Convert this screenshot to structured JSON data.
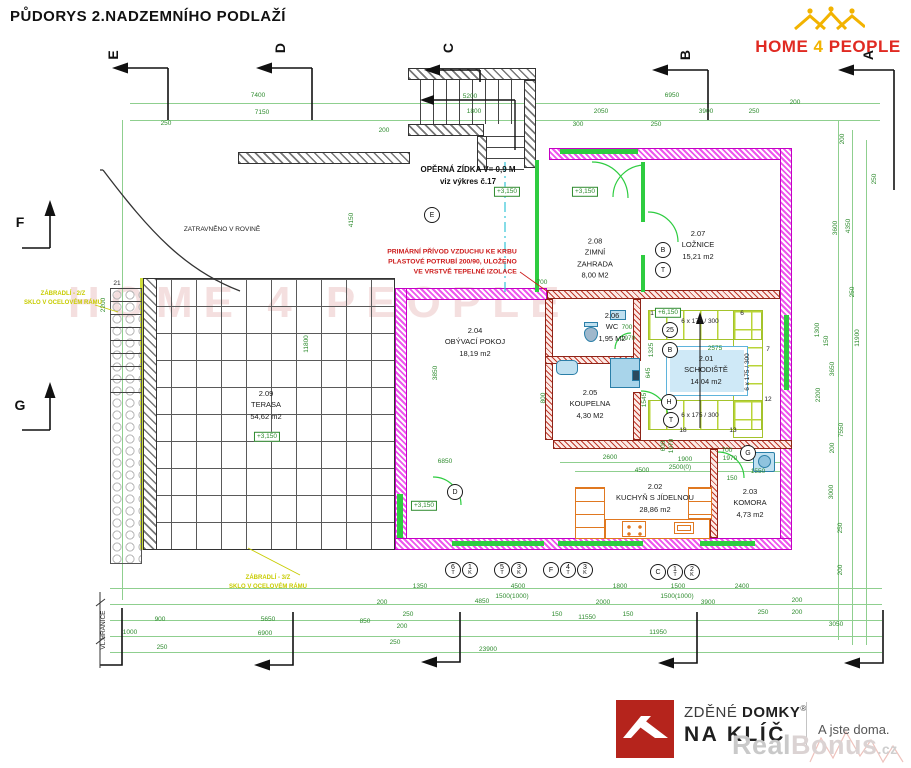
{
  "title": "PŮDORYS 2.NADZEMNÍHO PODLAŽÍ",
  "logo": {
    "word1": "HOME",
    "word2": "4",
    "word3": "PEOPLE"
  },
  "watermark_plan": "HOME 4 PEOPLE",
  "footer": {
    "brand1a": "ZDĚNÉ ",
    "brand1b": "DOMKY",
    "reg": "®",
    "brand2": "NA KLÍČ",
    "tagline": "A jste doma.",
    "wm1": "Real",
    "wm2": "Bonus",
    "wm3": ".cz"
  },
  "plan": {
    "rooms": [
      {
        "id": "2.01",
        "name": "SCHODIŠTĚ",
        "area": "14,04 m2",
        "x": 706,
        "y": 370
      },
      {
        "id": "2.02",
        "name": "KUCHYŇ S JÍDELNOU",
        "area": "28,86 m2",
        "x": 655,
        "y": 498
      },
      {
        "id": "2.03",
        "name": "KOMORA",
        "area": "4,73 m2",
        "x": 750,
        "y": 503
      },
      {
        "id": "2.04",
        "name": "OBÝVACÍ POKOJ",
        "area": "18,19 m2",
        "x": 475,
        "y": 342
      },
      {
        "id": "2.05",
        "name": "KOUPELNA",
        "area": "4,30 M2",
        "x": 590,
        "y": 404
      },
      {
        "id": "2.06",
        "name": "WC",
        "area": "1,95 M2",
        "x": 612,
        "y": 327
      },
      {
        "id": "2.07",
        "name": "LOŽNICE",
        "area": "15,21 m2",
        "x": 698,
        "y": 245
      },
      {
        "id": "2.08",
        "name": "ZIMNÍ\nZAHRADA",
        "area": "8,00 M2",
        "x": 595,
        "y": 258
      },
      {
        "id": "2.09",
        "name": "TERASA",
        "area": "54,62 m2",
        "x": 266,
        "y": 405
      }
    ],
    "elevations": [
      {
        "t": "+3,150",
        "x": 507,
        "y": 192
      },
      {
        "t": "+3,150",
        "x": 585,
        "y": 192
      },
      {
        "t": "+3,150",
        "x": 267,
        "y": 437
      },
      {
        "t": "+3,150",
        "x": 424,
        "y": 506
      },
      {
        "t": "+6,150",
        "x": 668,
        "y": 313
      }
    ],
    "notes": [
      {
        "t": "OPĚRNÁ ZÍDKA V= 0,9 M\nviz výkres č.17",
        "x": 468,
        "y": 176,
        "cls": "n-black"
      },
      {
        "t": "ZATRAVNĚNO V ROVINĚ",
        "x": 222,
        "y": 230,
        "cls": "n-small"
      },
      {
        "t": "PRIMÁRNÍ PŘÍVOD VZDUCHU KE KRBU\nPLASTOVÉ POTRUBÍ 200/90, ULOŽENO\nVE VRSTVĚ TEPELNÉ IZOLACE",
        "x": 452,
        "y": 263,
        "cls": "n-red"
      },
      {
        "t": "ZÁBRADLÍ - 2/Z\nSKLO V OCELOVÉM RÁMU",
        "x": 63,
        "y": 299,
        "cls": "n-yellow"
      },
      {
        "t": "ZÁBRADLÍ - 3/Z\nSKLO V OCELOVÉM RÁMU",
        "x": 268,
        "y": 583,
        "cls": "n-yellow"
      },
      {
        "t": "VL.HRANICE",
        "x": 104,
        "y": 630,
        "cls": "n-small",
        "r": 1
      }
    ],
    "stair_texts": [
      {
        "t": "6 x 175 / 300",
        "x": 700,
        "y": 322
      },
      {
        "t": "6 x 175 / 300",
        "x": 748,
        "y": 372,
        "r": 1
      },
      {
        "t": "6 x 175 / 300",
        "x": 700,
        "y": 416
      },
      {
        "t": "1",
        "x": 652,
        "y": 314
      },
      {
        "t": "6",
        "x": 742,
        "y": 314
      },
      {
        "t": "7",
        "x": 768,
        "y": 350
      },
      {
        "t": "12",
        "x": 768,
        "y": 400
      },
      {
        "t": "13",
        "x": 733,
        "y": 431
      },
      {
        "t": "18",
        "x": 683,
        "y": 431
      },
      {
        "t": "21",
        "x": 117,
        "y": 284
      }
    ],
    "section_letters": [
      {
        "t": "E",
        "x": 113,
        "y": 55,
        "r": 1
      },
      {
        "t": "D",
        "x": 280,
        "y": 48,
        "r": 1
      },
      {
        "t": "C",
        "x": 448,
        "y": 48,
        "r": 1
      },
      {
        "t": "B",
        "x": 685,
        "y": 55,
        "r": 1
      },
      {
        "t": "A",
        "x": 868,
        "y": 55,
        "r": 1
      },
      {
        "t": "F",
        "x": 20,
        "y": 222
      },
      {
        "t": "G",
        "x": 20,
        "y": 405
      }
    ],
    "markers": [
      {
        "t": "E",
        "x": 432,
        "y": 215
      },
      {
        "t": "D",
        "x": 455,
        "y": 492
      },
      {
        "t": "G",
        "x": 748,
        "y": 453
      },
      {
        "t": "B",
        "x": 663,
        "y": 250
      },
      {
        "t": "T",
        "x": 663,
        "y": 270
      },
      {
        "t": "25",
        "x": 670,
        "y": 330
      },
      {
        "t": "B",
        "x": 670,
        "y": 350
      },
      {
        "t": "H",
        "x": 669,
        "y": 402
      },
      {
        "t": "T",
        "x": 671,
        "y": 420
      },
      {
        "t": "F",
        "x": 551,
        "y": 570
      },
      {
        "t": "C",
        "x": 658,
        "y": 572
      },
      {
        "t": "6",
        "t2": "T",
        "x": 453,
        "y": 570
      },
      {
        "t": "1",
        "t2": "K",
        "x": 470,
        "y": 570
      },
      {
        "t": "5",
        "t2": "T",
        "x": 502,
        "y": 570
      },
      {
        "t": "3",
        "t2": "K",
        "x": 519,
        "y": 570
      },
      {
        "t": "4",
        "t2": "T",
        "x": 568,
        "y": 570
      },
      {
        "t": "3",
        "t2": "K",
        "x": 585,
        "y": 570
      },
      {
        "t": "1",
        "t2": "T",
        "x": 675,
        "y": 572
      },
      {
        "t": "2",
        "t2": "K",
        "x": 692,
        "y": 572
      }
    ],
    "dims": [
      {
        "t": "7400",
        "x": 258,
        "y": 96
      },
      {
        "t": "7150",
        "x": 262,
        "y": 113
      },
      {
        "t": "250",
        "x": 166,
        "y": 124
      },
      {
        "t": "200",
        "x": 384,
        "y": 131
      },
      {
        "t": "5200",
        "x": 470,
        "y": 97
      },
      {
        "t": "1800",
        "x": 474,
        "y": 112
      },
      {
        "t": "6950",
        "x": 672,
        "y": 96
      },
      {
        "t": "2050",
        "x": 601,
        "y": 112
      },
      {
        "t": "300",
        "x": 578,
        "y": 125
      },
      {
        "t": "250",
        "x": 656,
        "y": 125
      },
      {
        "t": "3900",
        "x": 706,
        "y": 112
      },
      {
        "t": "250",
        "x": 754,
        "y": 112
      },
      {
        "t": "200",
        "x": 795,
        "y": 103
      },
      {
        "t": "200",
        "x": 843,
        "y": 139,
        "r": 1
      },
      {
        "t": "4150",
        "x": 352,
        "y": 220,
        "r": 1
      },
      {
        "t": "2200",
        "x": 104,
        "y": 305,
        "r": 1
      },
      {
        "t": "11800",
        "x": 307,
        "y": 344,
        "r": 1
      },
      {
        "t": "3600",
        "x": 836,
        "y": 228,
        "r": 1
      },
      {
        "t": "4350",
        "x": 849,
        "y": 226,
        "r": 1
      },
      {
        "t": "250",
        "x": 875,
        "y": 179,
        "r": 1
      },
      {
        "t": "250",
        "x": 853,
        "y": 292,
        "r": 1
      },
      {
        "t": "1300",
        "x": 818,
        "y": 330,
        "r": 1
      },
      {
        "t": "150",
        "x": 827,
        "y": 341,
        "r": 1
      },
      {
        "t": "3650",
        "x": 833,
        "y": 369,
        "r": 1
      },
      {
        "t": "11900",
        "x": 858,
        "y": 338,
        "r": 1
      },
      {
        "t": "2200",
        "x": 819,
        "y": 395,
        "r": 1
      },
      {
        "t": "7550",
        "x": 842,
        "y": 430,
        "r": 1
      },
      {
        "t": "200",
        "x": 833,
        "y": 448,
        "r": 1
      },
      {
        "t": "3000",
        "x": 832,
        "y": 492,
        "r": 1
      },
      {
        "t": "250",
        "x": 841,
        "y": 528,
        "r": 1
      },
      {
        "t": "200",
        "x": 841,
        "y": 570,
        "r": 1
      },
      {
        "t": "200",
        "x": 797,
        "y": 601
      },
      {
        "t": "200",
        "x": 797,
        "y": 613
      },
      {
        "t": "3050",
        "x": 836,
        "y": 625
      },
      {
        "t": "1000",
        "x": 130,
        "y": 633
      },
      {
        "t": "900",
        "x": 160,
        "y": 620
      },
      {
        "t": "250",
        "x": 162,
        "y": 648
      },
      {
        "t": "5650",
        "x": 268,
        "y": 620
      },
      {
        "t": "6900",
        "x": 265,
        "y": 634
      },
      {
        "t": "850",
        "x": 365,
        "y": 622
      },
      {
        "t": "1350",
        "x": 420,
        "y": 587
      },
      {
        "t": "200",
        "x": 382,
        "y": 603
      },
      {
        "t": "250",
        "x": 408,
        "y": 615
      },
      {
        "t": "200",
        "x": 402,
        "y": 627
      },
      {
        "t": "250",
        "x": 395,
        "y": 643
      },
      {
        "t": "4850",
        "x": 482,
        "y": 602
      },
      {
        "t": "1500(1000)",
        "x": 512,
        "y": 597
      },
      {
        "t": "4500",
        "x": 518,
        "y": 587
      },
      {
        "t": "150",
        "x": 557,
        "y": 615
      },
      {
        "t": "2000",
        "x": 603,
        "y": 603
      },
      {
        "t": "11550",
        "x": 587,
        "y": 618
      },
      {
        "t": "1800",
        "x": 620,
        "y": 587
      },
      {
        "t": "150",
        "x": 628,
        "y": 615
      },
      {
        "t": "1500",
        "x": 678,
        "y": 587
      },
      {
        "t": "1500(1000)",
        "x": 677,
        "y": 597
      },
      {
        "t": "3900",
        "x": 708,
        "y": 603
      },
      {
        "t": "2400",
        "x": 742,
        "y": 587
      },
      {
        "t": "250",
        "x": 763,
        "y": 613
      },
      {
        "t": "11950",
        "x": 658,
        "y": 633
      },
      {
        "t": "23900",
        "x": 488,
        "y": 650
      },
      {
        "t": "2600",
        "x": 610,
        "y": 458
      },
      {
        "t": "1900",
        "x": 685,
        "y": 460
      },
      {
        "t": "4500",
        "x": 642,
        "y": 471
      },
      {
        "t": "2500(0)",
        "x": 680,
        "y": 468
      },
      {
        "t": "1550",
        "x": 758,
        "y": 472
      },
      {
        "t": "150",
        "x": 732,
        "y": 479
      },
      {
        "t": "700",
        "x": 727,
        "y": 451
      },
      {
        "t": "1970",
        "x": 730,
        "y": 459
      },
      {
        "t": "600",
        "x": 664,
        "y": 446,
        "r": 1
      },
      {
        "t": "1970",
        "x": 672,
        "y": 446,
        "r": 1
      },
      {
        "t": "700",
        "x": 627,
        "y": 328
      },
      {
        "t": "1970",
        "x": 628,
        "y": 339
      },
      {
        "t": "2575",
        "x": 715,
        "y": 349
      },
      {
        "t": "700",
        "x": 542,
        "y": 283
      },
      {
        "t": "800",
        "x": 544,
        "y": 398,
        "r": 1
      },
      {
        "t": "3850",
        "x": 436,
        "y": 373,
        "r": 1
      },
      {
        "t": "6850",
        "x": 445,
        "y": 462
      },
      {
        "t": "1325",
        "x": 652,
        "y": 350,
        "r": 1
      },
      {
        "t": "645",
        "x": 649,
        "y": 373,
        "r": 1
      },
      {
        "t": "1545",
        "x": 645,
        "y": 400,
        "r": 1
      }
    ]
  }
}
